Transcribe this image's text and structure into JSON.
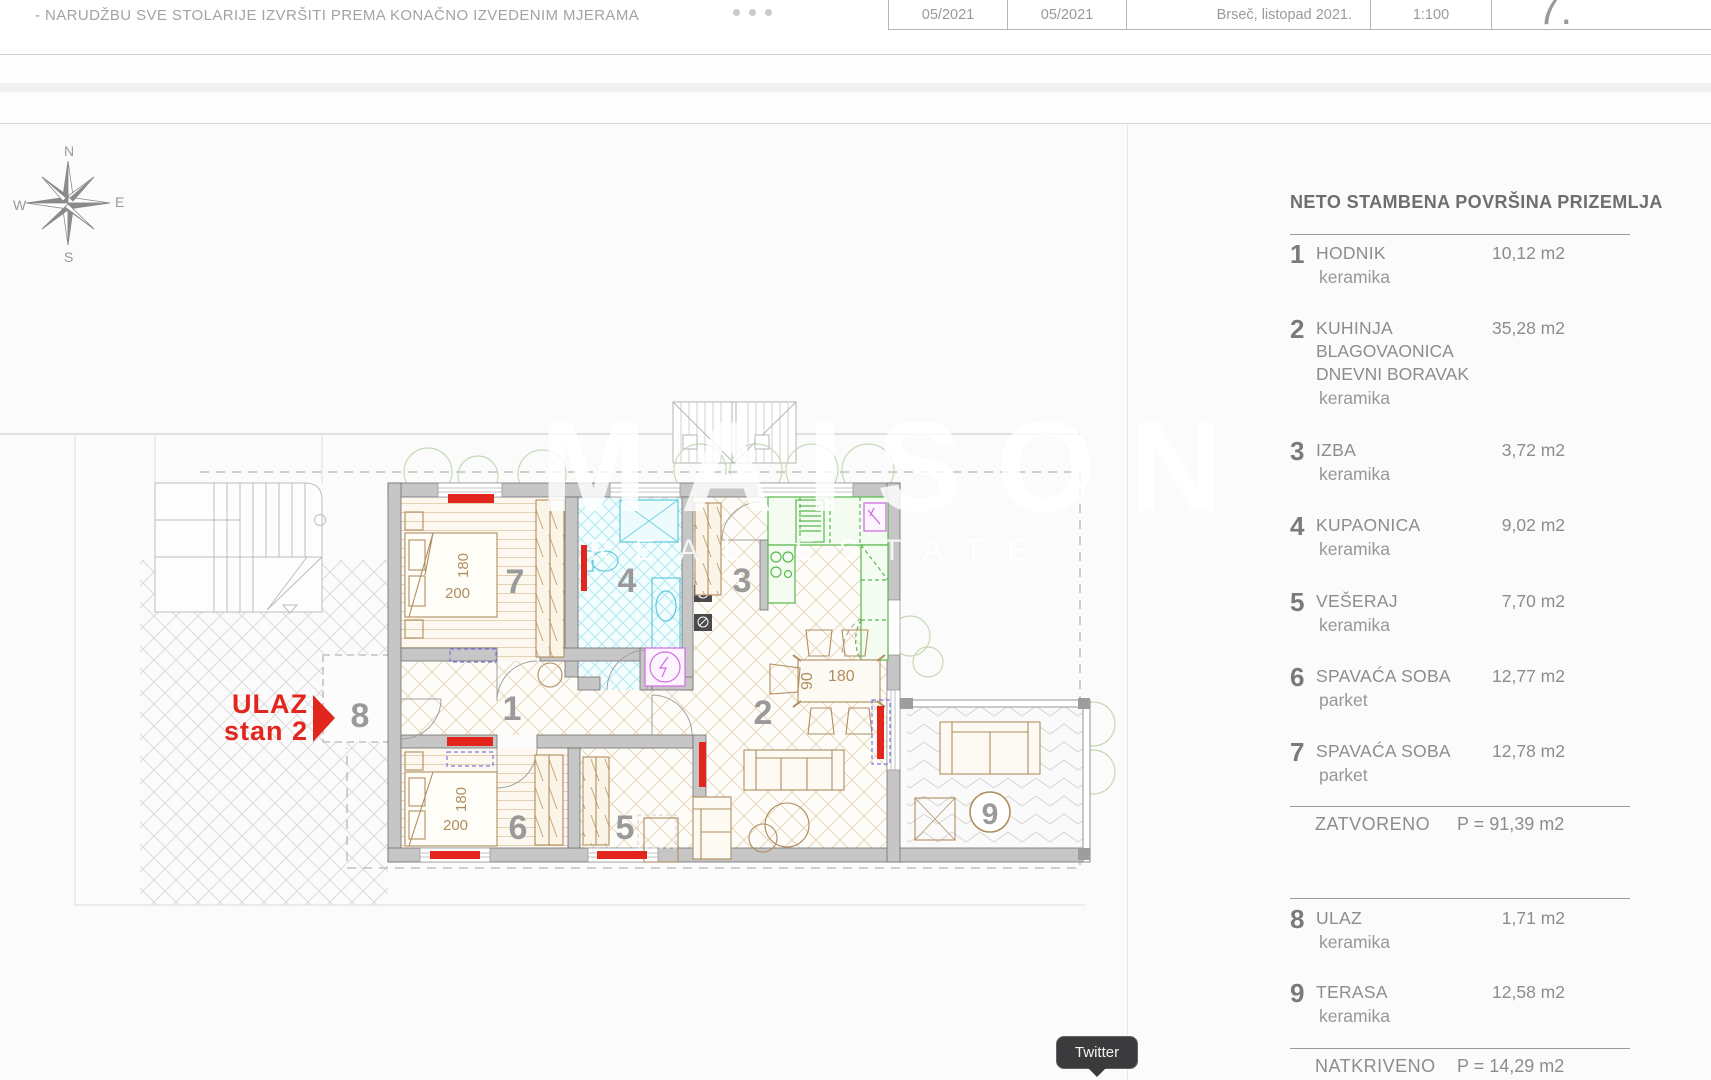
{
  "header": {
    "note": "- NARUDŽBU SVE STOLARIJE IZVRŠITI PREMA KONAČNO IZVEDENIM MJERAMA",
    "title_block": {
      "revision_date_1": "05/2021",
      "revision_date_2": "05/2021",
      "place_date": "Brseč, listopad 2021.",
      "scale": "1:100",
      "sheet_number": "7."
    }
  },
  "compass": {
    "north": "N",
    "east": "E",
    "south": "S",
    "west": "W"
  },
  "plan": {
    "entrance_label": {
      "line1": "ULAZ",
      "line2": "stan 2"
    },
    "room_numbers": {
      "r1": "1",
      "r2": "2",
      "r3": "3",
      "r4": "4",
      "r5": "5",
      "r6": "6",
      "r7": "7",
      "r8": "8",
      "r9": "9"
    },
    "dimensions": {
      "bed7_length": "200",
      "bed7_width": "180",
      "bed6_length": "200",
      "bed6_width": "180",
      "table_length": "180",
      "table_width": "90"
    }
  },
  "watermark": {
    "line1": "MAISON",
    "line2": "REAL ESTATE"
  },
  "legend": {
    "title": "NETO STAMBENA POVRŠINA PRIZEMLJA",
    "items": [
      {
        "num": "1",
        "name": "HODNIK",
        "name2": "",
        "name3": "",
        "material": "keramika",
        "area": "10,12 m2"
      },
      {
        "num": "2",
        "name": "KUHINJA",
        "name2": "BLAGOVAONICA",
        "name3": "DNEVNI BORAVAK",
        "material": "keramika",
        "area": "35,28 m2"
      },
      {
        "num": "3",
        "name": "IZBA",
        "name2": "",
        "name3": "",
        "material": "keramika",
        "area": "3,72 m2"
      },
      {
        "num": "4",
        "name": "KUPAONICA",
        "name2": "",
        "name3": "",
        "material": "keramika",
        "area": "9,02 m2"
      },
      {
        "num": "5",
        "name": "VEŠERAJ",
        "name2": "",
        "name3": "",
        "material": "keramika",
        "area": "7,70 m2"
      },
      {
        "num": "6",
        "name": "SPAVAĆA SOBA",
        "name2": "",
        "name3": "",
        "material": "parket",
        "area": "12,77 m2"
      },
      {
        "num": "7",
        "name": "SPAVAĆA SOBA",
        "name2": "",
        "name3": "",
        "material": "parket",
        "area": "12,78 m2"
      },
      {
        "num": "8",
        "name": "ULAZ",
        "name2": "",
        "name3": "",
        "material": "keramika",
        "area": "1,71 m2"
      },
      {
        "num": "9",
        "name": "TERASA",
        "name2": "",
        "name3": "",
        "material": "keramika",
        "area": "12,58 m2"
      }
    ],
    "closed_total": {
      "label": "ZATVORENO",
      "value": "P = 91,39 m2"
    },
    "covered_total": {
      "label": "NATKRIVENO",
      "value": "P = 14,29 m2"
    }
  },
  "tooltip": {
    "label": "Twitter"
  },
  "colors": {
    "accent_red": "#e3261d",
    "bath_cyan": "#5ecbdc",
    "kitchen_green": "#57b84b",
    "appliance_magenta": "#cf6ee0",
    "wood_tan": "#b08d5f"
  }
}
